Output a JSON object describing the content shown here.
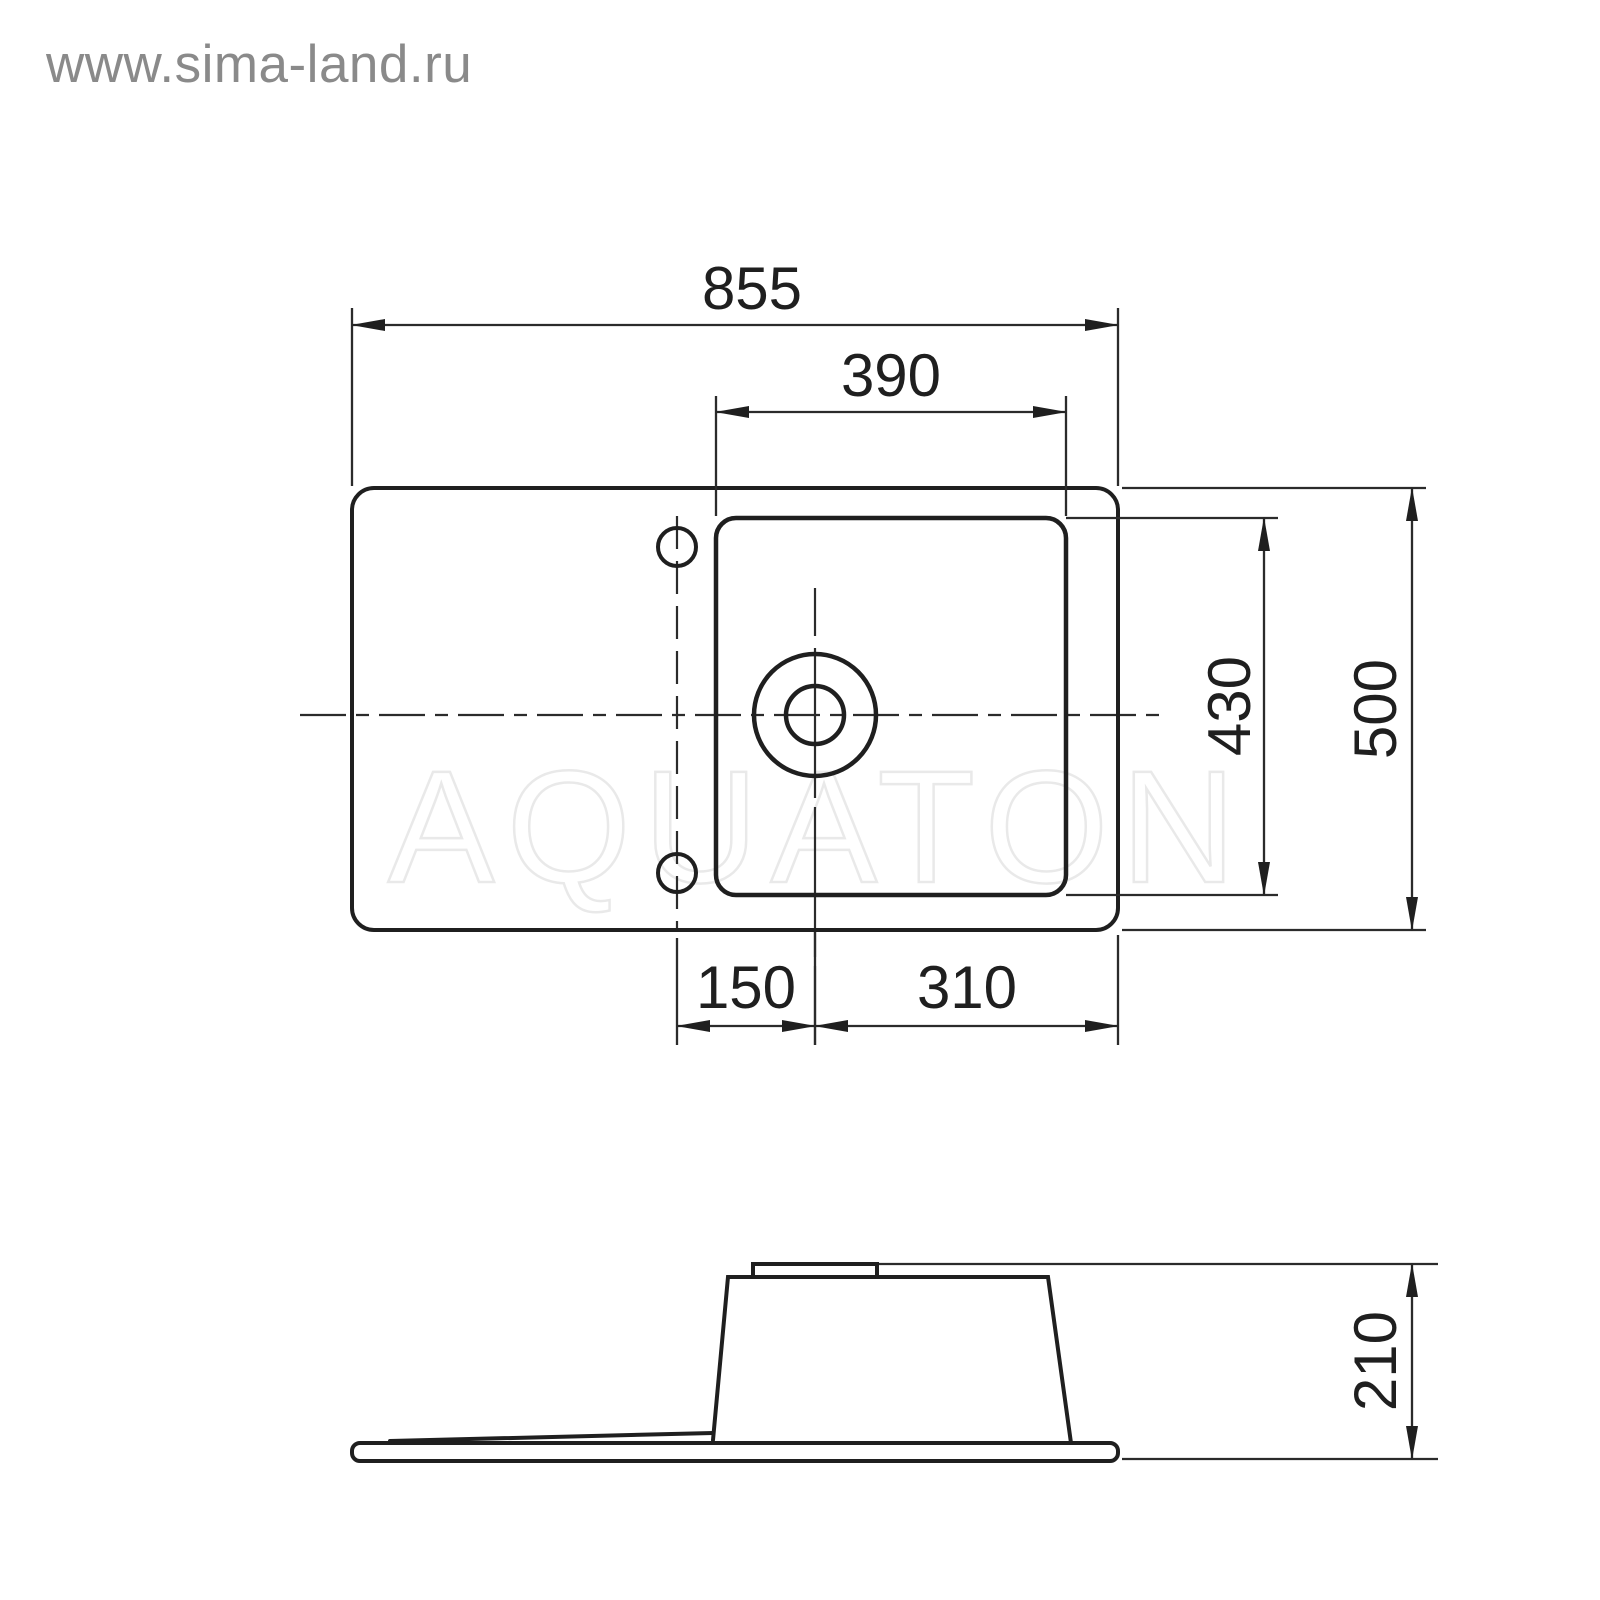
{
  "watermarks": {
    "site_label": "www.sima-land.ru",
    "brand_label": "AQUATON"
  },
  "dimensions": {
    "total_width": "855",
    "bowl_width": "390",
    "bowl_depth": "430",
    "total_depth": "500",
    "faucet_line_to_drain": "150",
    "drain_to_right_edge": "310",
    "side_height": "210"
  },
  "colors": {
    "background": "#ffffff",
    "drawing_line": "#1f1f1f",
    "site_watermark": "#8a8a8a",
    "brand_watermark_outline": "#e9e9e9"
  }
}
